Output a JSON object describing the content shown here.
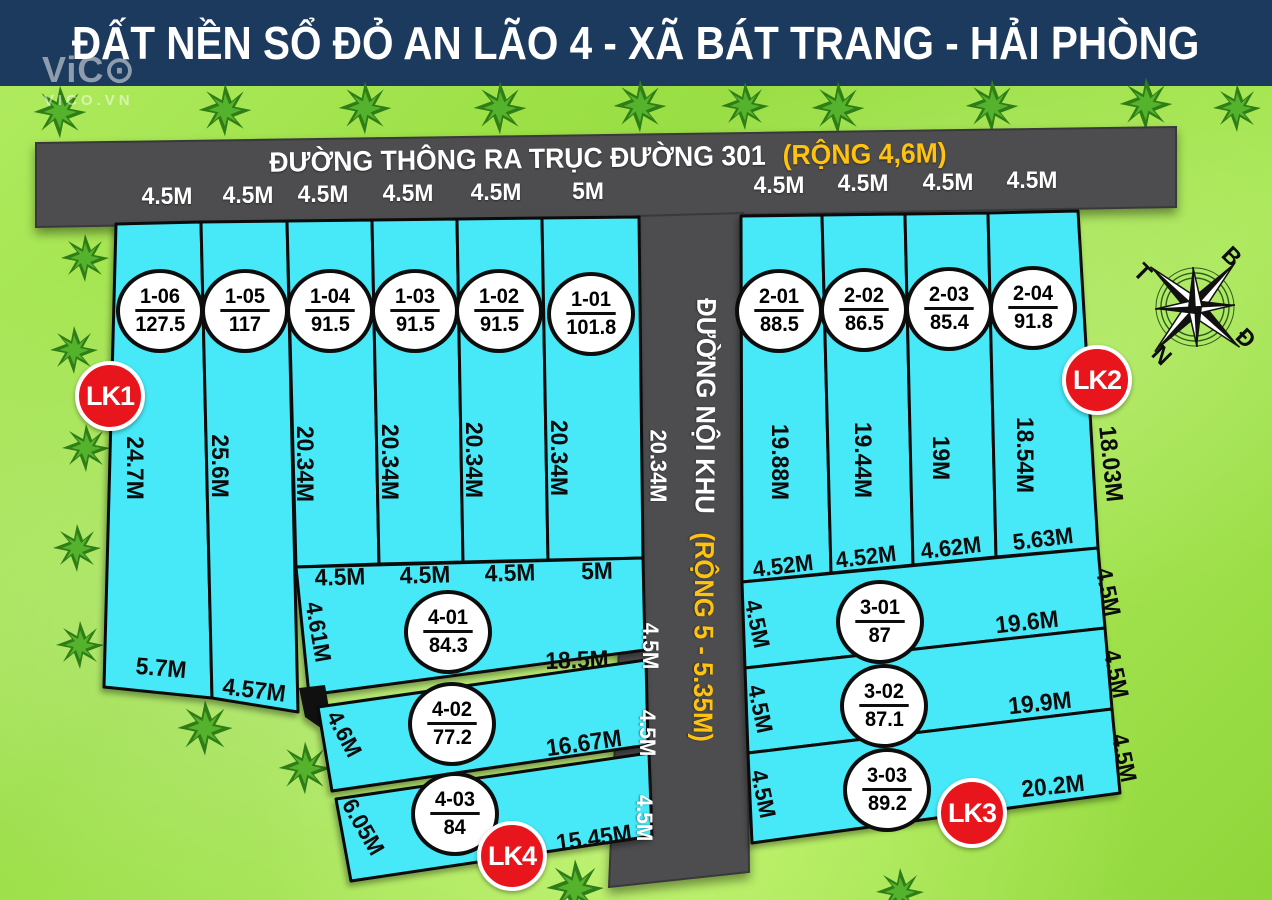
{
  "title": "ĐẤT NỀN SỔ ĐỎ AN LÃO 4 - XÃ BÁT TRANG - HẢI PHÒNG",
  "watermark": {
    "logo": "ViC⊙",
    "site": "VICO.VN"
  },
  "roads": {
    "top": {
      "name": "ĐƯỜNG THÔNG RA TRỤC ĐƯỜNG 301",
      "note": "(RỘNG 4,6M)"
    },
    "inner": {
      "name": "ĐƯỜNG NỘI KHU",
      "note": "(RỘNG 5 - 5.35M)",
      "side": [
        "20.34M",
        "4.5M",
        "4.5M",
        "4.5M"
      ]
    }
  },
  "compass": {
    "n": "B",
    "e": "Đ",
    "s": "N",
    "w": "T"
  },
  "badges": {
    "lk1": "LK1",
    "lk2": "LK2",
    "lk3": "LK3",
    "lk4": "LK4"
  },
  "colors": {
    "plot": "#47e9f8",
    "road": "#4d4d4f",
    "header": "#1c3a5d",
    "note_yellow": "#ffc20e",
    "badge_red": "#e8151c",
    "ground": "#a3e150"
  },
  "block1": {
    "top_widths": [
      "4.5M",
      "4.5M",
      "4.5M",
      "4.5M",
      "4.5M",
      "5M"
    ],
    "plots": [
      {
        "id": "1-06",
        "area": "127.5",
        "depth": "24.7M",
        "bottom": "5.7M"
      },
      {
        "id": "1-05",
        "area": "117",
        "depth": "25.6M",
        "bottom": "4.57M"
      },
      {
        "id": "1-04",
        "area": "91.5",
        "depth": "20.34M"
      },
      {
        "id": "1-03",
        "area": "91.5",
        "depth": "20.34M"
      },
      {
        "id": "1-02",
        "area": "91.5",
        "depth": "20.34M"
      },
      {
        "id": "1-01",
        "area": "101.8",
        "depth": "20.34M"
      }
    ]
  },
  "block2": {
    "top_widths": [
      "4.5M",
      "4.5M",
      "4.5M",
      "4.5M"
    ],
    "right_edge": "18.03M",
    "plots": [
      {
        "id": "2-01",
        "area": "88.5",
        "depth": "19.88M",
        "bottom": "4.52M"
      },
      {
        "id": "2-02",
        "area": "86.5",
        "depth": "19.44M",
        "bottom": "4.52M"
      },
      {
        "id": "2-03",
        "area": "85.4",
        "depth": "19M",
        "bottom": "4.62M"
      },
      {
        "id": "2-04",
        "area": "91.8",
        "depth": "18.54M",
        "bottom": "5.63M"
      }
    ]
  },
  "block3": {
    "plots": [
      {
        "id": "3-01",
        "area": "87",
        "left": "4.5M",
        "right": "19.6M",
        "edge": "4.5M"
      },
      {
        "id": "3-02",
        "area": "87.1",
        "left": "4.5M",
        "right": "19.9M",
        "edge": "4.5M"
      },
      {
        "id": "3-03",
        "area": "89.2",
        "left": "4.5M",
        "right": "20.2M",
        "edge": "4.5M"
      }
    ]
  },
  "block4": {
    "strip_widths": [
      "4.5M",
      "4.5M",
      "4.5M",
      "5M"
    ],
    "plots": [
      {
        "id": "4-01",
        "area": "84.3",
        "left": "4.61M",
        "right": "18.5M"
      },
      {
        "id": "4-02",
        "area": "77.2",
        "left": "4.6M",
        "right": "16.67M"
      },
      {
        "id": "4-03",
        "area": "84",
        "left": "6.05M",
        "right": "15.45M"
      }
    ]
  }
}
